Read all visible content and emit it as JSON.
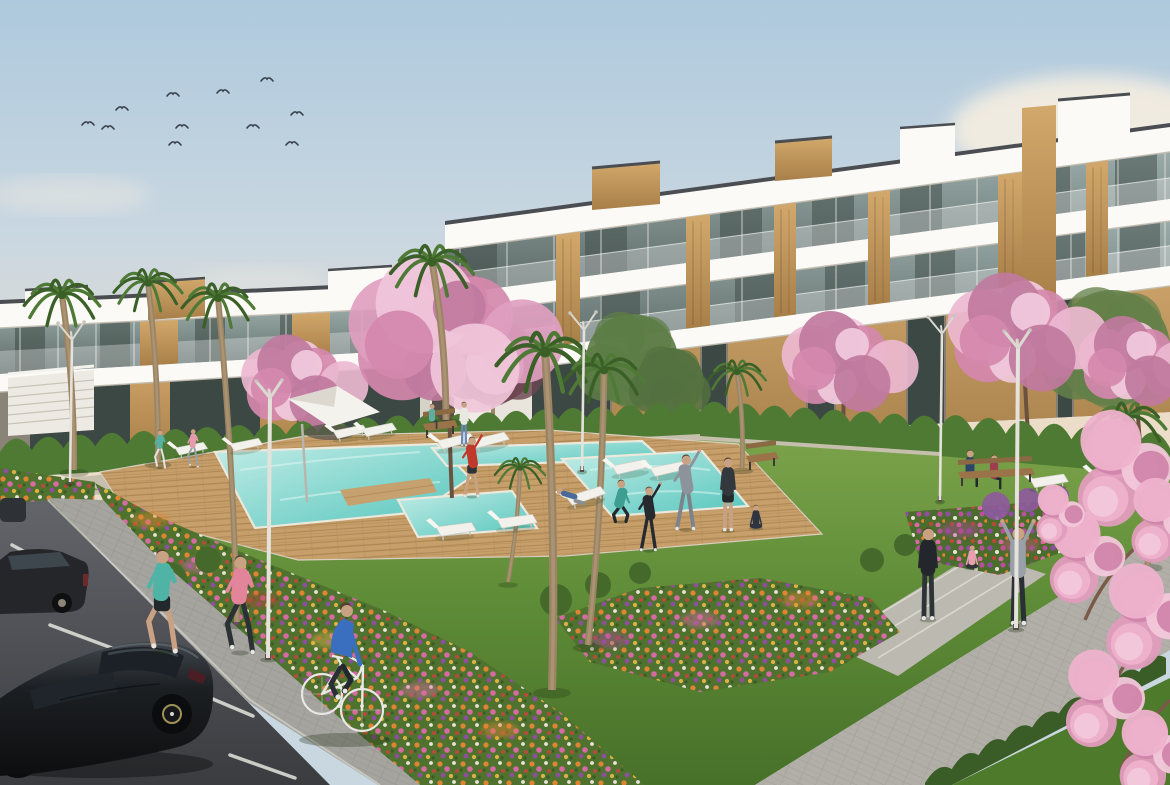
{
  "scene": {
    "caption": "3D architectural rendering of a modern white apartment complex: three-storey terraced buildings with wood panels and glass balconies around a landscaped courtyard with a turquoise swimming pool, wooden deck, flower beds, palm and cherry-blossom trees; people exercise on the lawn, two joggers and a cyclist pass in the foreground and dark cars sit in a parking area at lower left; birds fly in a soft blue sky."
  },
  "palette": {
    "sky_top": "#aec9dd",
    "sky_mid": "#c9d7e1",
    "sky_horizon": "#e6ddd0",
    "cloud": "#f6eee1",
    "building_white": "#f6f4ee",
    "building_slab": "#fbfaf6",
    "building_shadow": "#c2bcb0",
    "roof_trim": "#4a4e52",
    "glass_light": "#9aaba9",
    "glass_dark": "#5a6865",
    "glass_interior": "#3c4844",
    "wood_light": "#d2a86c",
    "wood_dark": "#a87f48",
    "hedge": "#4e7a33",
    "hedge_dark": "#3a5c26",
    "lawn_light": "#7aa24a",
    "lawn_mid": "#5d8a36",
    "lawn_dark": "#477029",
    "deck": "#c79f6b",
    "deck_line": "#a9824f",
    "pool_shallow": "#c2ece6",
    "pool_deep": "#55c6bd",
    "pool_coping": "#ece8dc",
    "paving_far": "#c6bfae",
    "path_gray": "#b2afa8",
    "sidewalk": "#a5a49f",
    "road_light": "#63656a",
    "road_dark": "#3a3c40",
    "stripe_white": "#e5e5df",
    "car_black": "#141619",
    "bike_frame": "#e8e8e4",
    "blossom_light": "#ecb8d0",
    "blossom_mid": "#d488ad",
    "blossom_deep": "#c07a9e",
    "palm_green": "#4f7a36",
    "palm_dark": "#3a5f27",
    "trunk_brown": "#9b8464",
    "skin": "#c9a183",
    "soil_green": "#4f732f",
    "flower_orange": "#e08433",
    "flower_pink": "#d66ba3",
    "flower_purple": "#8e4f9e",
    "flower_yellow": "#ddb244",
    "flower_red": "#b84a38",
    "flower_white": "#ece4da"
  },
  "birds": [
    {
      "x": 88,
      "y": 123
    },
    {
      "x": 108,
      "y": 127
    },
    {
      "x": 122,
      "y": 108
    },
    {
      "x": 173,
      "y": 94
    },
    {
      "x": 182,
      "y": 126
    },
    {
      "x": 175,
      "y": 143
    },
    {
      "x": 223,
      "y": 91
    },
    {
      "x": 253,
      "y": 126
    },
    {
      "x": 267,
      "y": 79
    },
    {
      "x": 292,
      "y": 143
    },
    {
      "x": 297,
      "y": 113
    }
  ],
  "lamps": [
    {
      "id": "lamp-left",
      "x": 70,
      "yb": 482,
      "yt": 340,
      "big": false,
      "front": false
    },
    {
      "id": "lamp-center-walkway",
      "x": 582,
      "yb": 470,
      "yt": 330,
      "big": false,
      "front": false
    },
    {
      "id": "lamp-right-rear",
      "x": 940,
      "yb": 500,
      "yt": 334,
      "big": false,
      "front": false
    },
    {
      "id": "lamp-pool-foreground",
      "x": 268,
      "yb": 658,
      "yt": 398,
      "big": true,
      "front": true
    },
    {
      "id": "lamp-path-foreground",
      "x": 1016,
      "yb": 628,
      "yt": 348,
      "big": true,
      "front": true
    }
  ],
  "loungers": [
    {
      "x": 175,
      "y": 448,
      "a": -8,
      "s": 0.85
    },
    {
      "x": 230,
      "y": 444,
      "a": -8,
      "s": 0.85
    },
    {
      "x": 333,
      "y": 431,
      "a": -8,
      "s": 0.9
    },
    {
      "x": 362,
      "y": 429,
      "a": -8,
      "s": 0.9
    },
    {
      "x": 437,
      "y": 441,
      "a": -10,
      "s": 1
    },
    {
      "x": 471,
      "y": 440,
      "a": -10,
      "s": 1
    },
    {
      "x": 436,
      "y": 527,
      "a": -4,
      "s": 1.05
    },
    {
      "x": 497,
      "y": 519,
      "a": -4,
      "s": 1.05
    },
    {
      "x": 612,
      "y": 466,
      "a": -8,
      "s": 1
    },
    {
      "x": 650,
      "y": 468,
      "a": -8,
      "s": 1
    },
    {
      "x": 566,
      "y": 497,
      "a": -14,
      "s": 1.05
    },
    {
      "x": 1030,
      "y": 479,
      "a": -5,
      "s": 1
    },
    {
      "x": 1092,
      "y": 473,
      "a": -5,
      "s": 1
    }
  ],
  "parking_stripes": [
    [
      25,
      580,
      55,
      603
    ],
    [
      50,
      625,
      112,
      648
    ],
    [
      100,
      668,
      165,
      702
    ],
    [
      208,
      697,
      253,
      716
    ],
    [
      230,
      755,
      295,
      778
    ],
    [
      12,
      545,
      40,
      560
    ]
  ],
  "palms": [
    {
      "x": 62,
      "y": 295,
      "bx": 74,
      "by": 470,
      "s": 1.05
    },
    {
      "x": 148,
      "y": 283,
      "bx": 158,
      "by": 462,
      "s": 0.95
    },
    {
      "x": 218,
      "y": 298,
      "bx": 237,
      "by": 622,
      "s": 1.0
    },
    {
      "x": 432,
      "y": 262,
      "bx": 446,
      "by": 420,
      "s": 1.15
    },
    {
      "x": 545,
      "y": 352,
      "bx": 552,
      "by": 690,
      "s": 1.35
    },
    {
      "x": 604,
      "y": 370,
      "bx": 588,
      "by": 645,
      "s": 1.1
    },
    {
      "x": 737,
      "y": 372,
      "bx": 742,
      "by": 468,
      "s": 0.8
    },
    {
      "x": 1128,
      "y": 418,
      "bx": 1148,
      "by": 565,
      "s": 1.05
    },
    {
      "x": 520,
      "y": 468,
      "bx": 508,
      "by": 582,
      "s": 0.7
    }
  ],
  "blossom_trees": [
    {
      "x": 300,
      "y": 378,
      "r": 52,
      "bx": 300,
      "by": 478
    },
    {
      "x": 845,
      "y": 358,
      "r": 56,
      "bx": 845,
      "by": 455
    },
    {
      "x": 1022,
      "y": 328,
      "r": 66,
      "bx": 1028,
      "by": 432
    },
    {
      "x": 1135,
      "y": 358,
      "r": 50,
      "bx": 1140,
      "by": 442
    }
  ],
  "big_blossom_tree": {
    "x": 448,
    "y": 328,
    "r": 88,
    "bx": 452,
    "by": 498
  },
  "green_trees": [
    {
      "x": 493,
      "y": 362,
      "r": 42,
      "c": "#6d4650"
    },
    {
      "x": 632,
      "y": 360,
      "r": 46,
      "c": "#5d7d46"
    },
    {
      "x": 670,
      "y": 382,
      "r": 34,
      "c": "#547240"
    },
    {
      "x": 1112,
      "y": 348,
      "r": 58,
      "c": "#64804a"
    }
  ],
  "foreground_blossoms": [
    {
      "x": 1128,
      "y": 468,
      "r": 55
    },
    {
      "x": 1090,
      "y": 556,
      "r": 44
    },
    {
      "x": 1152,
      "y": 616,
      "r": 50
    },
    {
      "x": 1108,
      "y": 698,
      "r": 46
    },
    {
      "x": 1158,
      "y": 754,
      "r": 42
    },
    {
      "x": 1062,
      "y": 514,
      "r": 28
    },
    {
      "x": 1168,
      "y": 520,
      "r": 40
    }
  ],
  "people": [
    {
      "id": "jogger-left",
      "x": 162,
      "y": 550,
      "h": 102,
      "top": "#4fb3a5",
      "bottom": "#23282c",
      "pose": "run",
      "legs_skin": true
    },
    {
      "id": "jogger-right",
      "x": 240,
      "y": 556,
      "h": 97,
      "top": "#e2849a",
      "bottom": "#2c3136",
      "pose": "run"
    },
    {
      "id": "walker-teal-deck",
      "x": 160,
      "y": 430,
      "h": 38,
      "top": "#57b0a2",
      "bottom": "#e8e5de",
      "pose": "run"
    },
    {
      "id": "walker-pink-deck",
      "x": 193,
      "y": 429,
      "h": 38,
      "top": "#e59aad",
      "bottom": "#9aa0a4",
      "pose": "run"
    },
    {
      "id": "man-red-stretch",
      "x": 472,
      "y": 437,
      "h": 60,
      "top": "#c0392b",
      "bottom": "#2e3338",
      "pose": "stretch",
      "legs_skin": true
    },
    {
      "id": "woman-blue-dress",
      "x": 464,
      "y": 402,
      "h": 44,
      "top": "#e9e7e2",
      "bottom": "#6a88b8",
      "pose": "stand"
    },
    {
      "id": "bench-sitter-small",
      "x": 432,
      "y": 404,
      "h": 38,
      "top": "#5fae9f",
      "bottom": "#3a4046",
      "pose": "sit"
    },
    {
      "id": "recliner-blue",
      "x": 560,
      "y": 489,
      "h": 55,
      "top": "#4a6a9a",
      "bottom": "#8a8f94",
      "pose": "recline"
    },
    {
      "id": "woman-crouch-teal",
      "x": 621,
      "y": 480,
      "h": 62,
      "top": "#3f9e92",
      "bottom": "#23282c",
      "pose": "crouch"
    },
    {
      "id": "kid-tracksuit",
      "x": 649,
      "y": 487,
      "h": 64,
      "top": "#26292e",
      "bottom": "#26292e",
      "pose": "stretch"
    },
    {
      "id": "man-gray-stretch",
      "x": 686,
      "y": 455,
      "h": 75,
      "top": "#8d939a",
      "bottom": "#7d838a",
      "pose": "stretch"
    },
    {
      "id": "man-dark-stand",
      "x": 728,
      "y": 458,
      "h": 73,
      "top": "#33383e",
      "bottom": "#23282c",
      "pose": "stand",
      "legs_skin": true
    },
    {
      "id": "woman-yoga-seated",
      "x": 756,
      "y": 505,
      "h": 42,
      "top": "#2e3440",
      "bottom": "#2e3440",
      "pose": "sitfloor"
    },
    {
      "id": "woman-path-stand",
      "x": 928,
      "y": 528,
      "h": 92,
      "top": "#23272c",
      "bottom": "#2e3338",
      "pose": "stand"
    },
    {
      "id": "woman-sit-pink",
      "x": 972,
      "y": 545,
      "h": 42,
      "top": "#e8a0b0",
      "bottom": "#2e3338",
      "pose": "sitfloor"
    },
    {
      "id": "person-arms-up",
      "x": 1018,
      "y": 527,
      "h": 98,
      "top": "#9aa0a8",
      "bottom": "#2b3036",
      "pose": "armsup"
    },
    {
      "id": "bench-man-navy",
      "x": 970,
      "y": 450,
      "h": 56,
      "top": "#2c4668",
      "bottom": "#23282c",
      "pose": "sit"
    },
    {
      "id": "bench-woman-red",
      "x": 994,
      "y": 455,
      "h": 52,
      "top": "#9e3c50",
      "bottom": "#23282c",
      "pose": "sit"
    }
  ]
}
